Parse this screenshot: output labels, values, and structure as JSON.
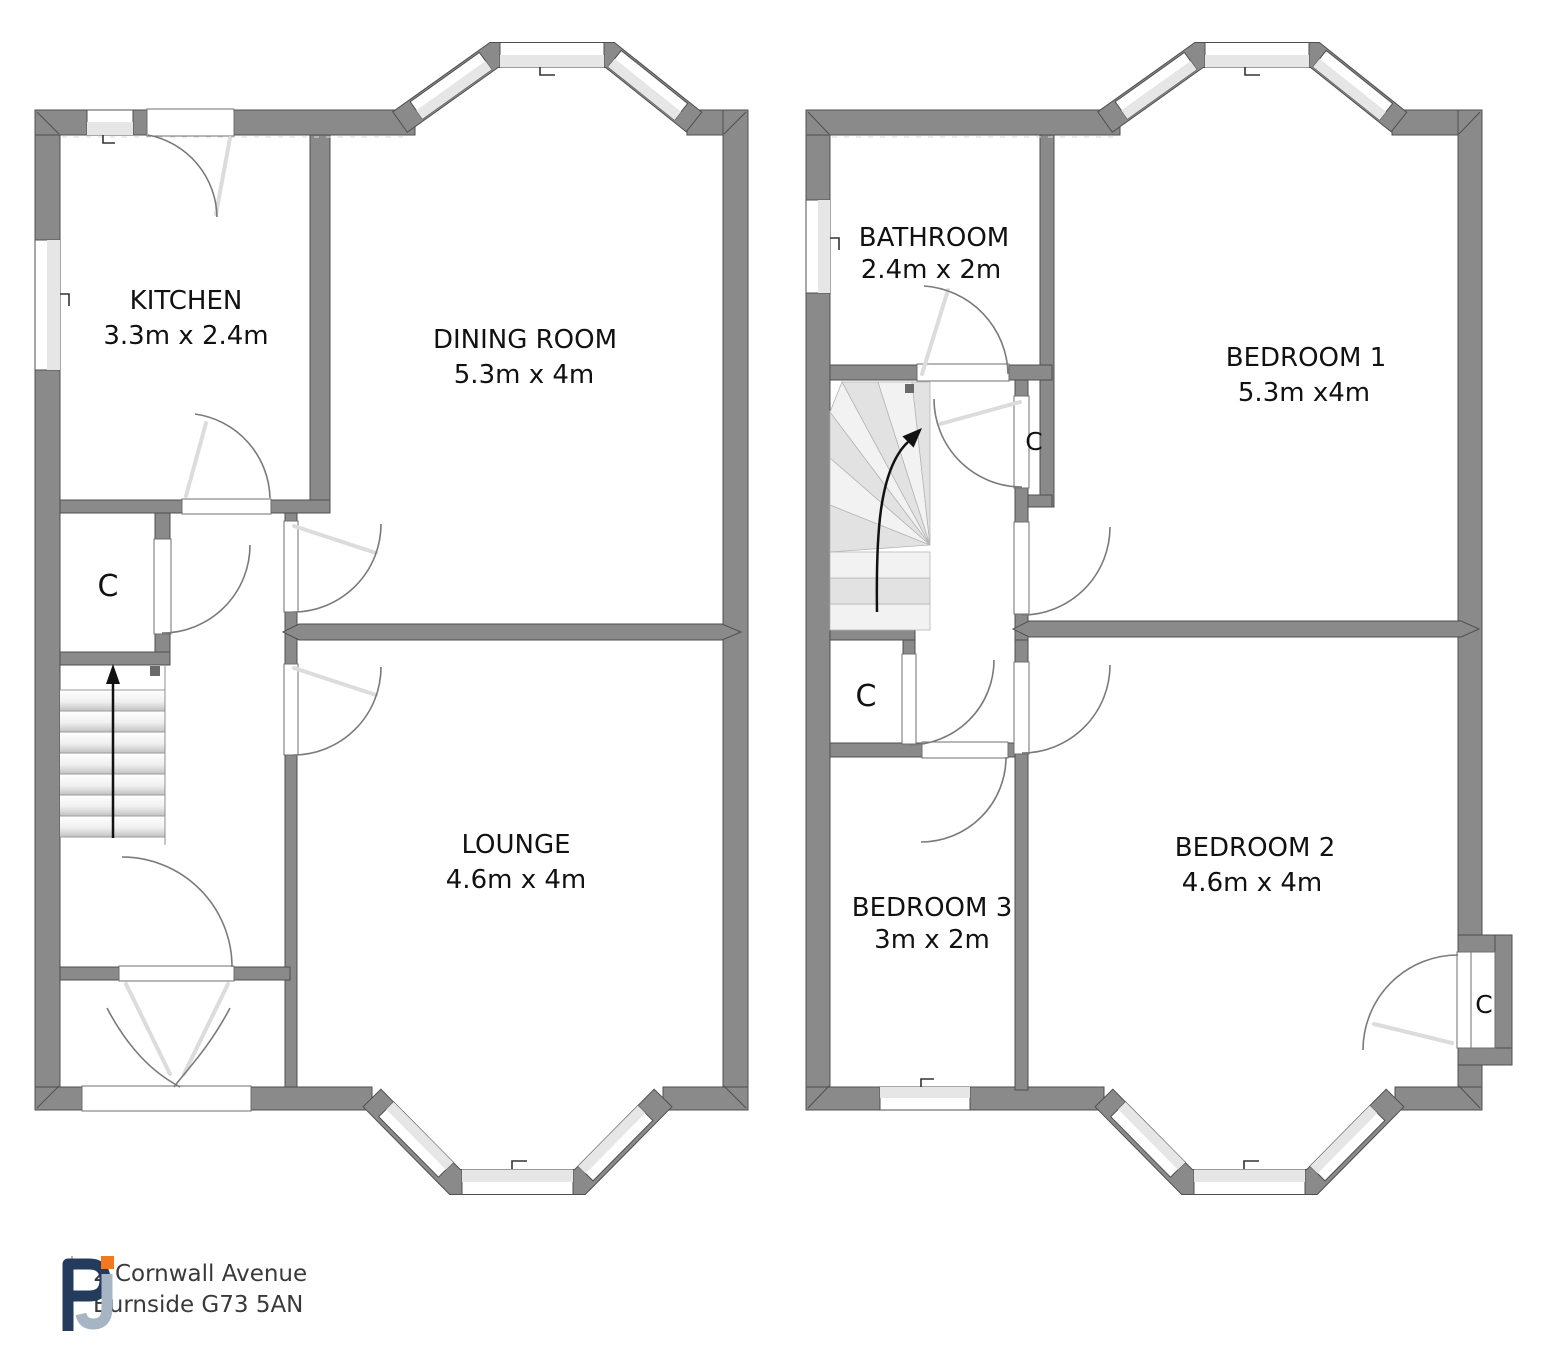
{
  "rooms": {
    "kitchen": {
      "name": "KITCHEN",
      "dims": "3.3m x 2.4m"
    },
    "dining_room": {
      "name": "DINING ROOM",
      "dims": "5.3m x 4m"
    },
    "lounge": {
      "name": "LOUNGE",
      "dims": "4.6m x 4m"
    },
    "bathroom": {
      "name": "BATHROOM",
      "dims": "2.4m x 2m"
    },
    "bedroom1": {
      "name": "BEDROOM 1",
      "dims": "5.3m  x4m"
    },
    "bedroom2": {
      "name": "BEDROOM 2",
      "dims": "4.6m x 4m"
    },
    "bedroom3": {
      "name": "BEDROOM 3",
      "dims": "3m x 2m"
    },
    "closet_label": "C"
  },
  "footer": {
    "logo_letter_p": "P",
    "logo_letter_j": "J",
    "address_line1": "2 Cornwall Avenue",
    "address_line2": "Burnside G73 5AN"
  },
  "colors": {
    "wall": "#8a8a8a",
    "wall_edge": "#4f4f4f",
    "window_band": "#e6e6e6",
    "logo_navy": "#243b5e",
    "logo_blue_grey": "#a6b4c4",
    "logo_orange": "#f2791f"
  }
}
